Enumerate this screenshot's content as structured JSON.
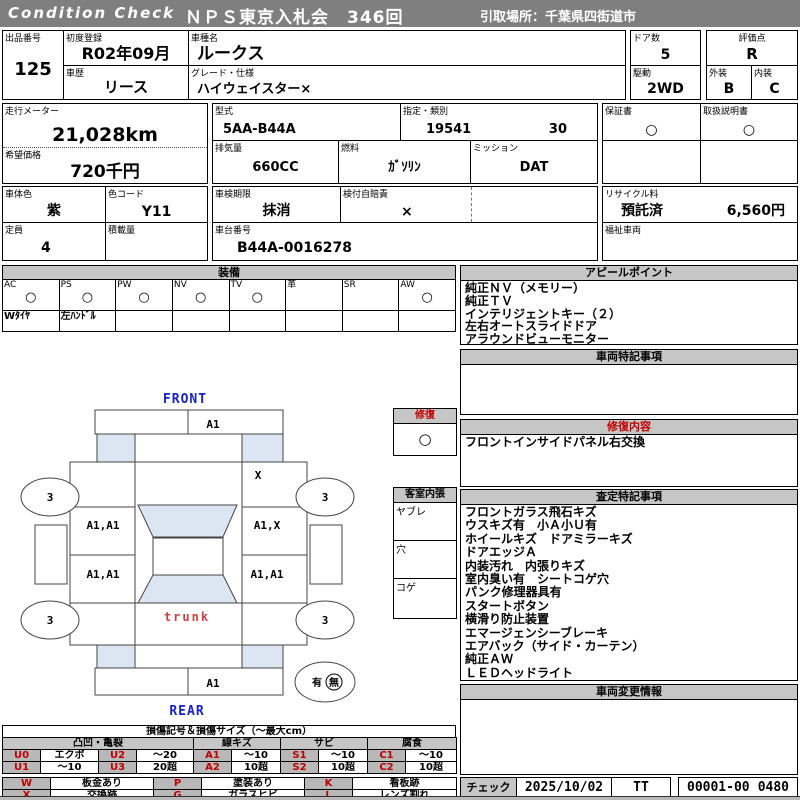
{
  "header": {
    "brand": "Condition  Check",
    "title": "ＮＰＳ東京入札会　346回",
    "pickup": "引取場所：千葉県四街道市"
  },
  "top": {
    "lot_label": "出品番号",
    "lot": "125",
    "first_reg_label": "初度登録",
    "first_reg": "R02年09月",
    "model_label": "車種名",
    "model": "ルークス",
    "history_label": "車歴",
    "history": "リース",
    "grade_label": "グレード・仕様",
    "grade": "ハイウェイスター×",
    "doors_label": "ドア数",
    "doors": "5",
    "drive_label": "駆動",
    "drive": "2WD",
    "score_label": "評価点",
    "score": "R",
    "ext_label": "外装",
    "ext": "B",
    "int_label": "内装",
    "int": "C"
  },
  "meters": {
    "odo_label": "走行メーター",
    "odo": "21,028km",
    "price_label": "希望価格",
    "price": "720千円",
    "model_code_label": "型式",
    "model_code": "5AA-B44A",
    "class_label": "指定・類別",
    "class_no": "19541",
    "class_sub": "30",
    "disp_label": "排気量",
    "disp": "660CC",
    "fuel_label": "燃料",
    "fuel": "ｶﾞｿﾘﾝ",
    "mission_label": "ミッション",
    "mission": "DAT",
    "warranty_label": "保証書",
    "warranty": "○",
    "manual_label": "取扱説明書",
    "manual": "○"
  },
  "details": {
    "color_label": "車体色",
    "color": "紫",
    "color_code_label": "色コード",
    "color_code": "Y11",
    "capacity_label": "定員",
    "capacity": "4",
    "load_label": "積載量",
    "load": "",
    "inspection_label": "車検期限",
    "inspection": "抹消",
    "insurance_label": "検付自賠責",
    "insurance": "×",
    "chassis_label": "車台番号",
    "chassis": "B44A-0016278",
    "recycle_label": "リサイクル料",
    "recycle_status": "預託済",
    "recycle_fee": "6,560円",
    "welfare_label": "福祉車両"
  },
  "equipment": {
    "title": "装備",
    "items": [
      {
        "label": "AC",
        "mark": "○",
        "note": "Wﾀｲﾔ"
      },
      {
        "label": "PS",
        "mark": "○",
        "note": "左ﾊﾝﾄﾞﾙ"
      },
      {
        "label": "PW",
        "mark": "○",
        "note": ""
      },
      {
        "label": "NV",
        "mark": "○",
        "note": ""
      },
      {
        "label": "TV",
        "mark": "○",
        "note": ""
      },
      {
        "label": "革",
        "mark": "",
        "note": ""
      },
      {
        "label": "SR",
        "mark": "",
        "note": ""
      },
      {
        "label": "AW",
        "mark": "○",
        "note": ""
      }
    ]
  },
  "sections": {
    "appeal": {
      "title": "アピールポイント",
      "lines": [
        "純正ＮＶ（メモリー）",
        "純正ＴＶ",
        "インテリジェントキー（２）",
        "左右オートスライドドア",
        "アラウンドビューモニター"
      ]
    },
    "notes": {
      "title": "車両特記事項",
      "lines": []
    },
    "repair": {
      "title": "修復内容",
      "lines": [
        "フロントインサイドパネル右交換"
      ]
    },
    "assessment": {
      "title": "査定特記事項",
      "lines": [
        "フロントガラス飛石キズ",
        "ウスキズ有　小Ａ小Ｕ有",
        "ホイールキズ　ドアミラーキズ",
        "ドアエッジＡ",
        "内装汚れ　内張りキズ",
        "室内臭い有　シートコゲ穴",
        "パンク修理器具有",
        "スタートボタン",
        "横滑り防止装置",
        "エマージェンシーブレーキ",
        "エアバック（サイド・カーテン）",
        "純正ＡＷ",
        "ＬＥＤヘッドライト"
      ]
    },
    "changes": {
      "title": "車両変更情報",
      "lines": []
    }
  },
  "check": {
    "label": "チェック",
    "date": "2025/10/02",
    "inspector": "TT",
    "code": "00001-00",
    "code2": "0480"
  },
  "diagram": {
    "front": "FRONT",
    "rear": "REAR",
    "trunk": "trunk",
    "front_bumper": "A1",
    "rear_bumper": "A1",
    "rf_fender": "X",
    "lf_door": "A1,A1",
    "rf_door": "A1,X",
    "lr_door": "A1,A1",
    "rr_door": "A1,A1",
    "tire_fl": "3",
    "tire_fr": "3",
    "tire_rl": "3",
    "tire_rr": "3",
    "spare_has": "有",
    "spare_none": "無",
    "repair_title": "修復",
    "repair_mark": "○",
    "cabin_title": "客室内張",
    "cabin_rows": [
      "ヤブレ",
      "穴",
      "コゲ"
    ]
  },
  "legend": {
    "title": "損傷記号＆損傷サイズ（～最大cm）",
    "groups": [
      "凸凹・亀裂",
      "線キズ",
      "サビ",
      "腐食"
    ],
    "row1": [
      {
        "c": "U0",
        "v": "エクボ"
      },
      {
        "c": "U2",
        "v": "～20"
      },
      {
        "c": "A1",
        "v": "～10"
      },
      {
        "c": "S1",
        "v": "～10"
      },
      {
        "c": "C1",
        "v": "～10"
      }
    ],
    "row2": [
      {
        "c": "U1",
        "v": "～10"
      },
      {
        "c": "U3",
        "v": "20超"
      },
      {
        "c": "A2",
        "v": "10超"
      },
      {
        "c": "S2",
        "v": "10超"
      },
      {
        "c": "C2",
        "v": "10超"
      }
    ],
    "row3": [
      {
        "c": "W",
        "v": "板金あり"
      },
      {
        "c": "P",
        "v": "塗装あり"
      },
      {
        "c": "K",
        "v": "看板跡"
      }
    ],
    "row4": [
      {
        "c": "X",
        "v": "交換跡"
      },
      {
        "c": "G",
        "v": "ガラスヒビ"
      },
      {
        "c": "L",
        "v": "レンズ割れ"
      }
    ]
  }
}
